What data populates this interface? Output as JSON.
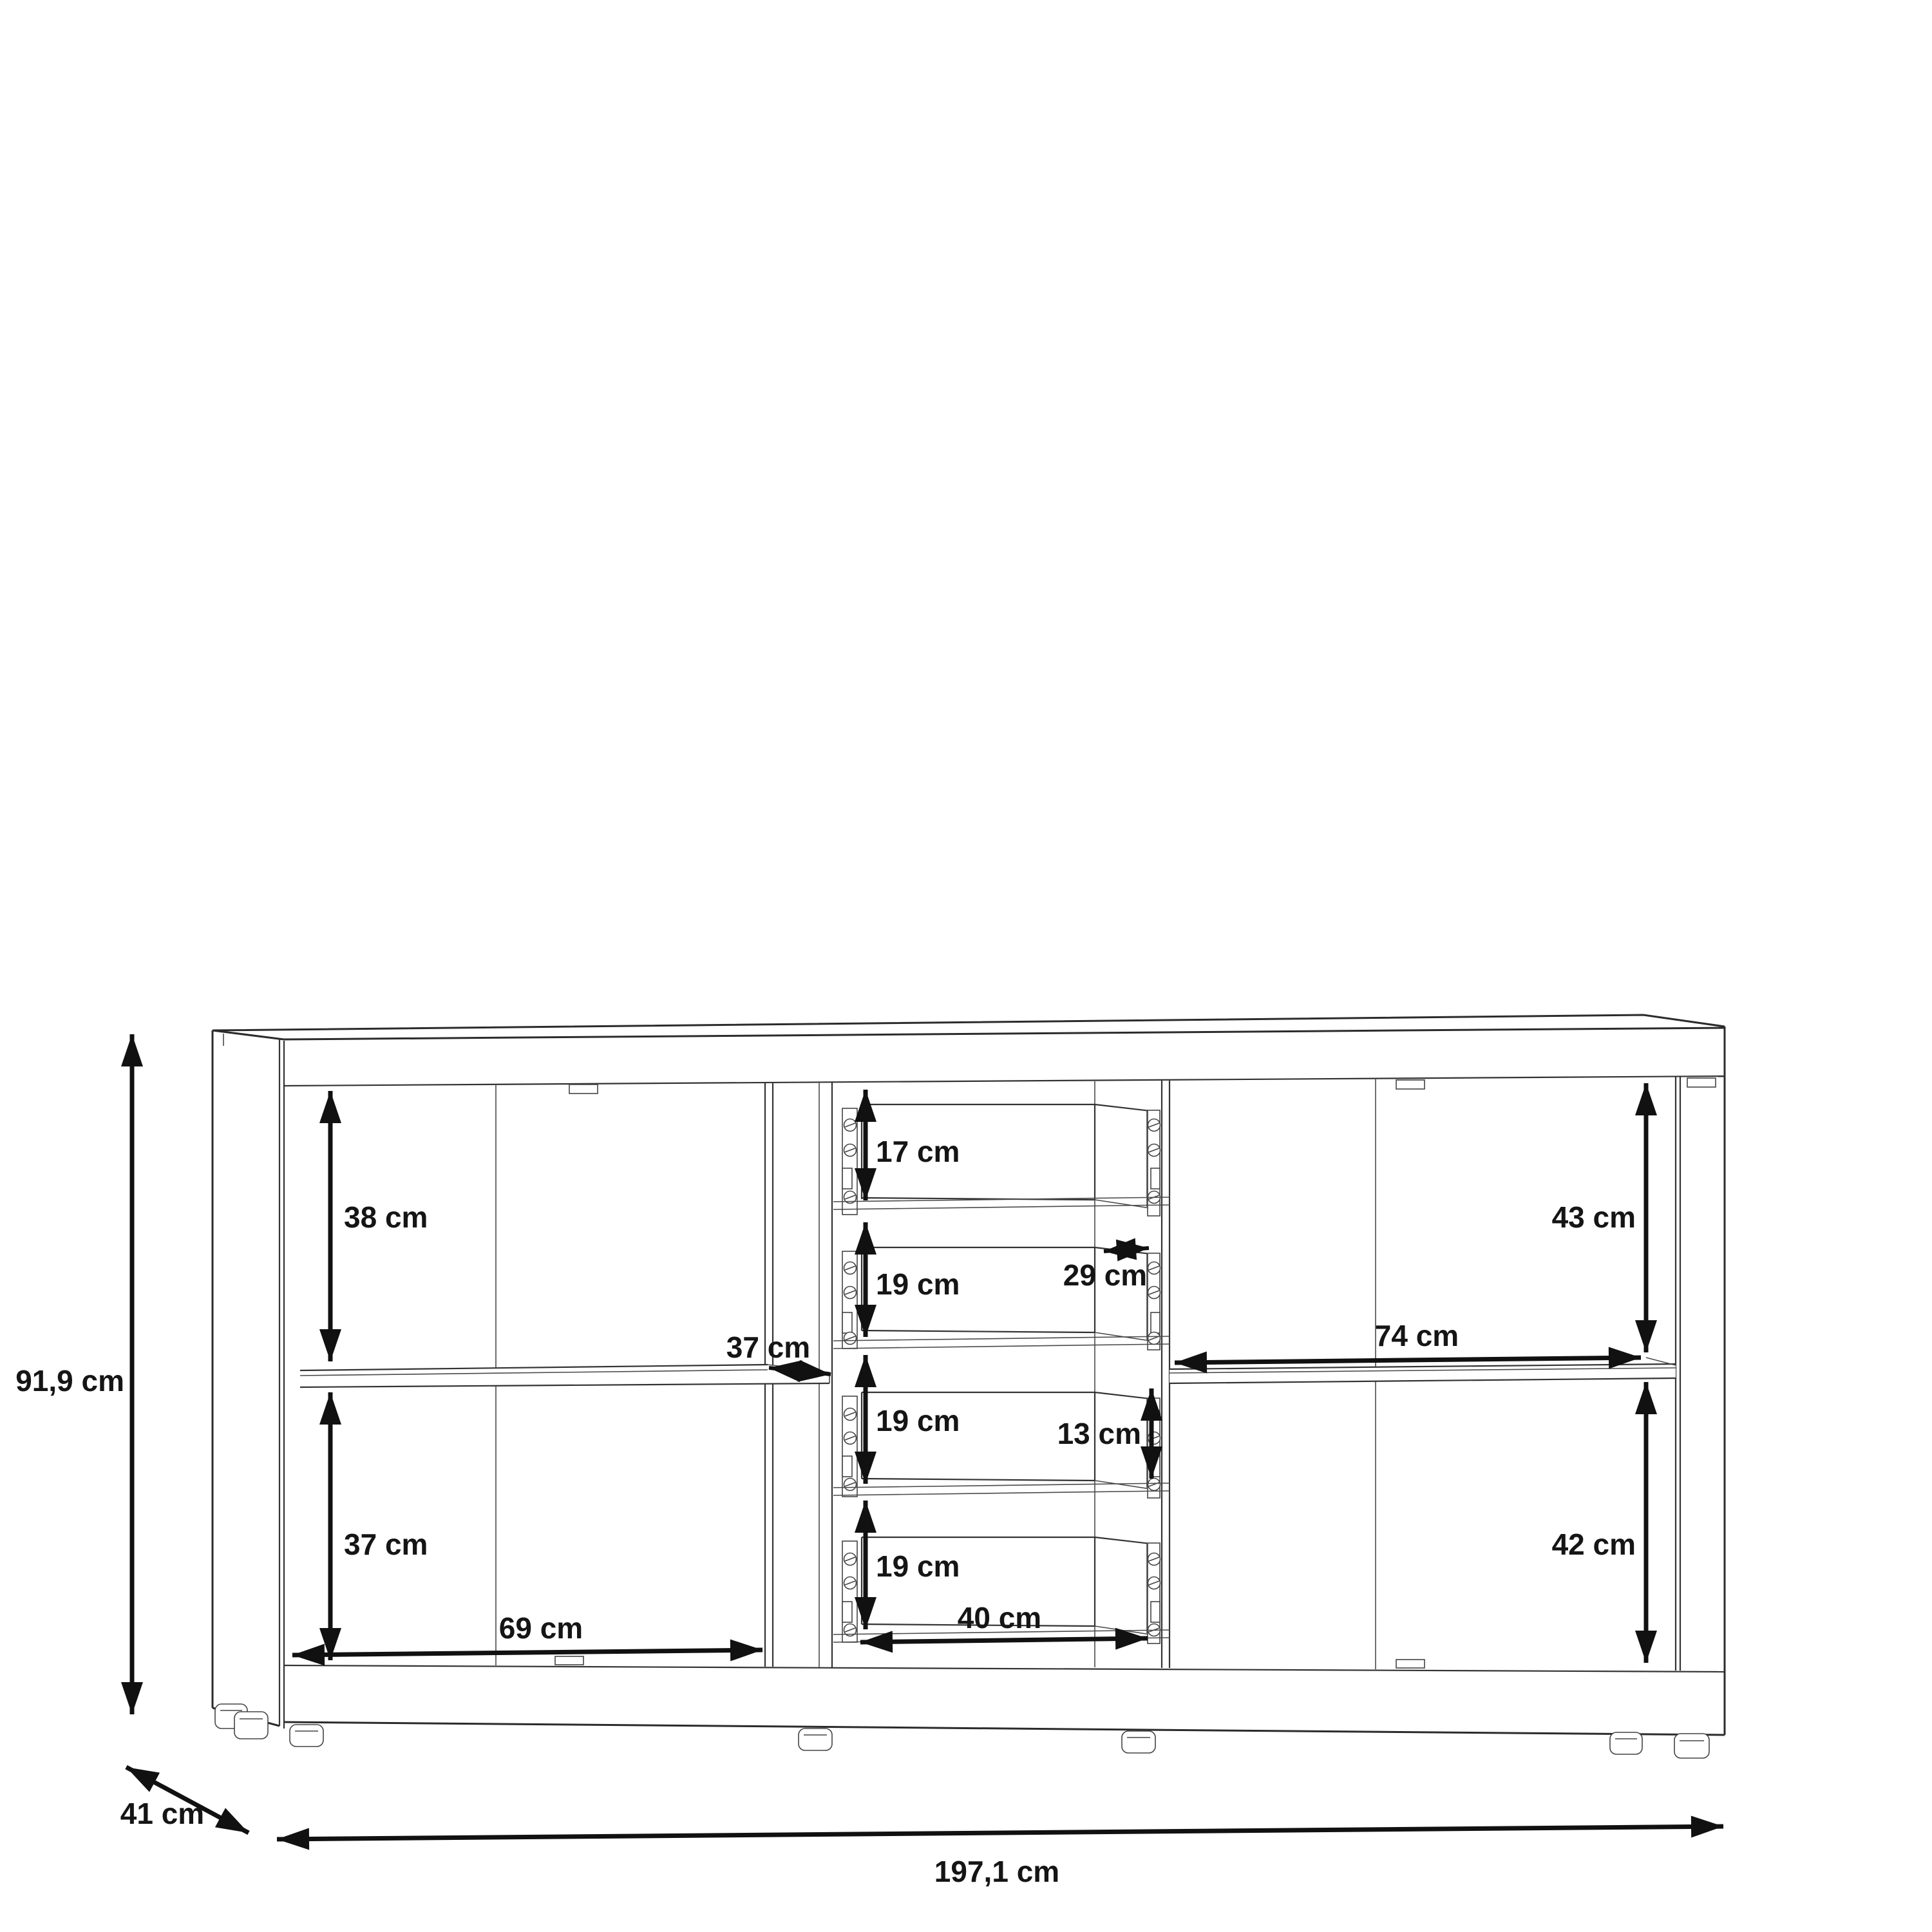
{
  "diagram": {
    "type": "furniture-dimension-drawing",
    "object": "sideboard",
    "units": "cm",
    "dims": {
      "overall": {
        "height": "91,9 cm",
        "depth": "41 cm",
        "width": "197,1 cm"
      },
      "left": {
        "upper_compartment": "38 cm",
        "lower_compartment": "37 cm",
        "door_width": "69 cm",
        "shelf_depth": "37 cm"
      },
      "drawers": {
        "drawer1": "17 cm",
        "drawer2": "19 cm",
        "drawer3": "19 cm",
        "drawer4": "19 cm",
        "inner_depth": "29 cm",
        "inner_height": "13 cm",
        "width": "40 cm"
      },
      "right": {
        "upper_compartment": "43 cm",
        "lower_compartment": "42 cm",
        "shelf_width": "74 cm"
      }
    }
  }
}
